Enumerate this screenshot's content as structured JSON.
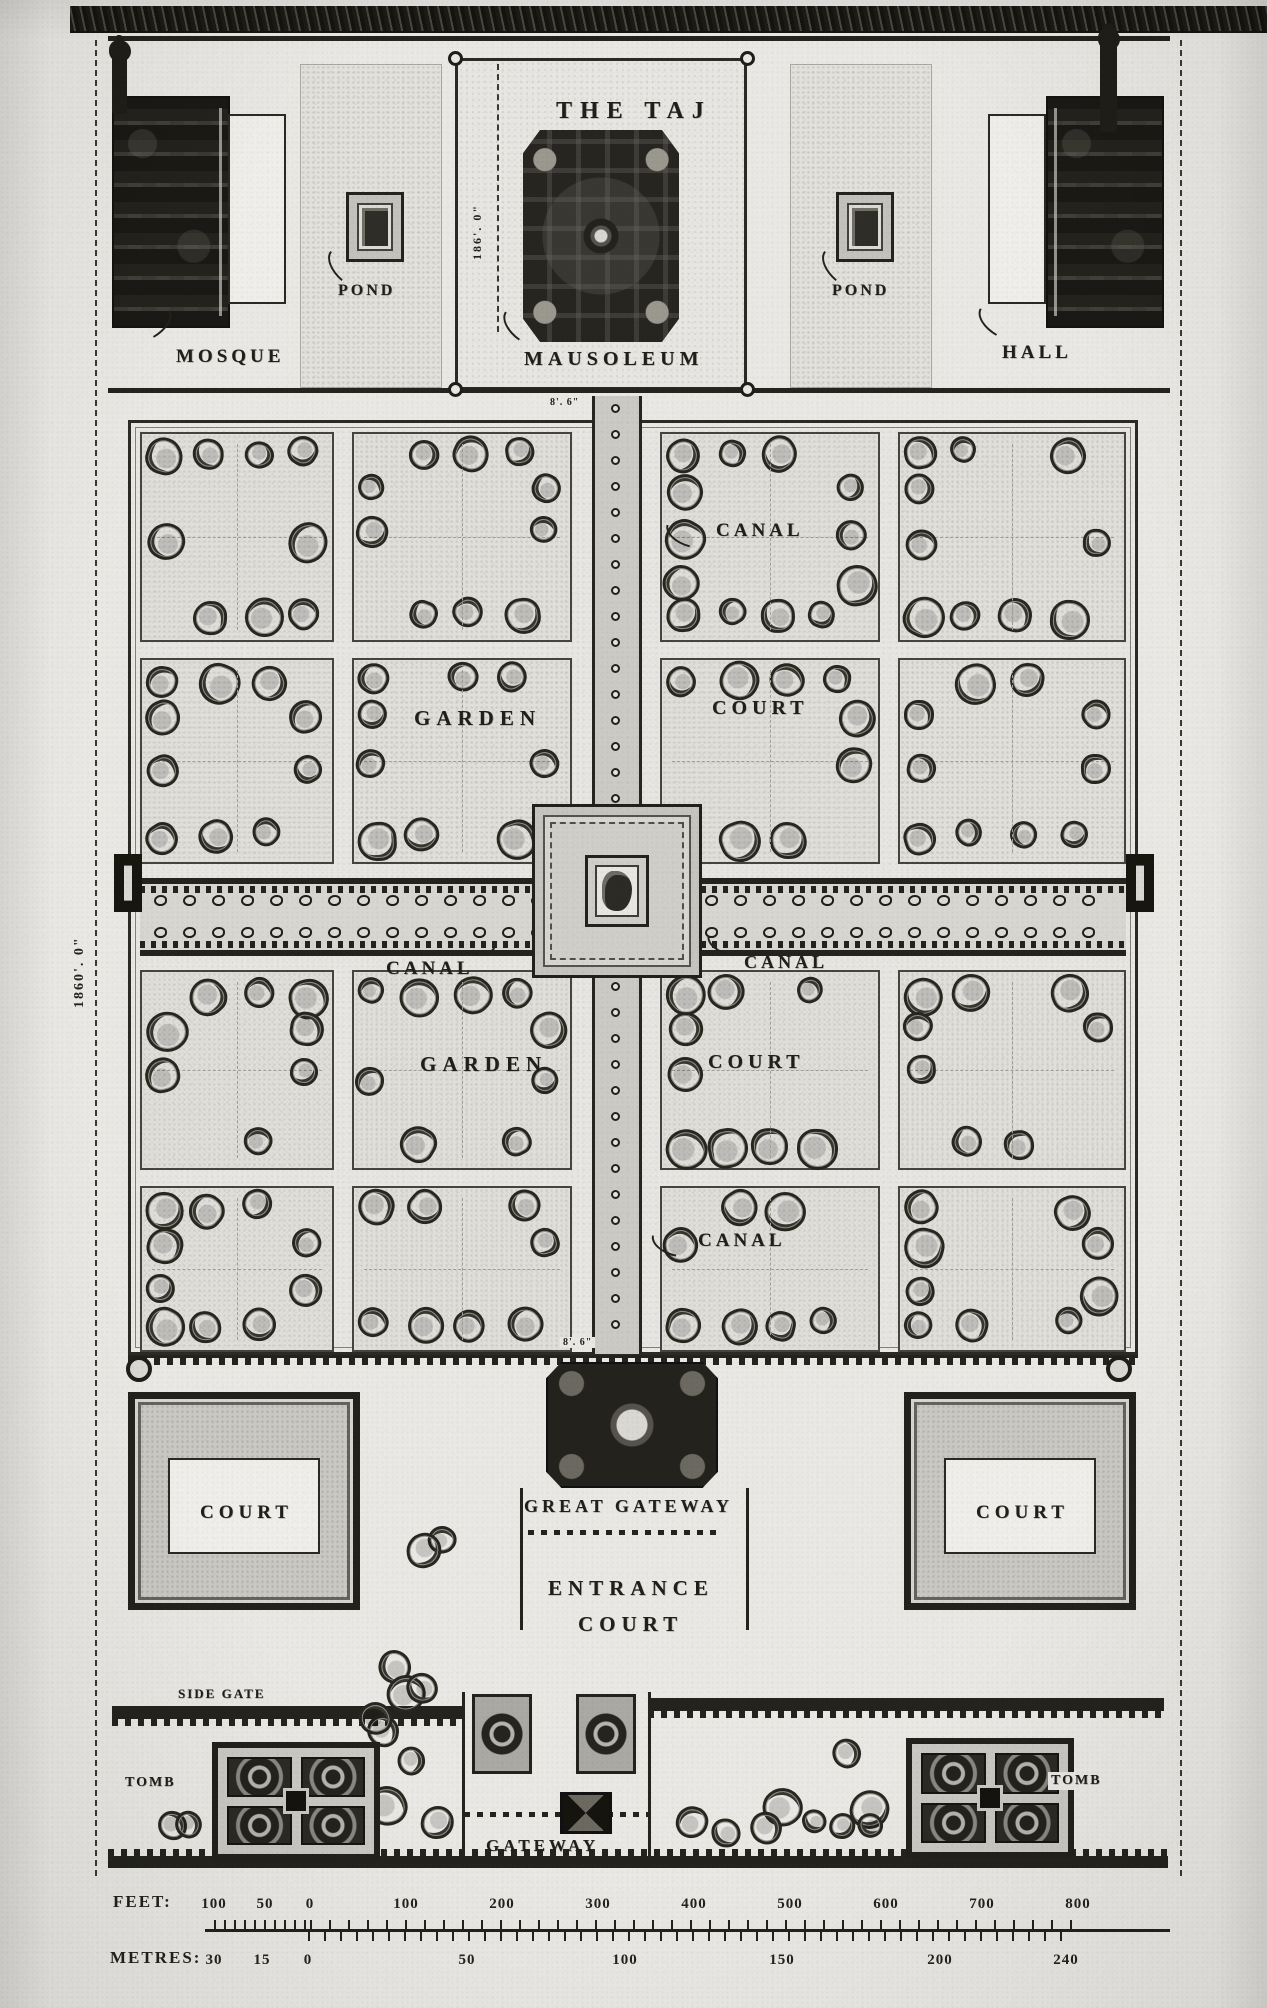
{
  "labels": {
    "title": "THE TAJ",
    "mausoleum": "MAUSOLEUM",
    "mosque": "MOSQUE",
    "hall": "HALL",
    "pond": "POND",
    "canal": "CANAL",
    "garden": "GARDEN",
    "court": "COURT",
    "great_gateway": "GREAT GATEWAY",
    "entrance_line1": "ENTRANCE",
    "entrance_line2": "COURT",
    "gateway": "GATEWAY",
    "tomb": "TOMB",
    "side_gate": "SIDE GATE"
  },
  "dimensions": {
    "overall_length": "1860'. 0\"",
    "mausoleum_width": "186'. 0\"",
    "canal_width": "8'. 6\""
  },
  "scale": {
    "feet_label": "FEET:",
    "metres_label": "METRES:",
    "feet_ticks": [
      "100",
      "50",
      "0",
      "100",
      "200",
      "300",
      "400",
      "500",
      "600",
      "700",
      "800"
    ],
    "metres_ticks": [
      "30",
      "15",
      "0",
      "50",
      "100",
      "150",
      "200",
      "240"
    ]
  },
  "colors": {
    "paper": "#e9e8e4",
    "ink": "#23221c"
  }
}
